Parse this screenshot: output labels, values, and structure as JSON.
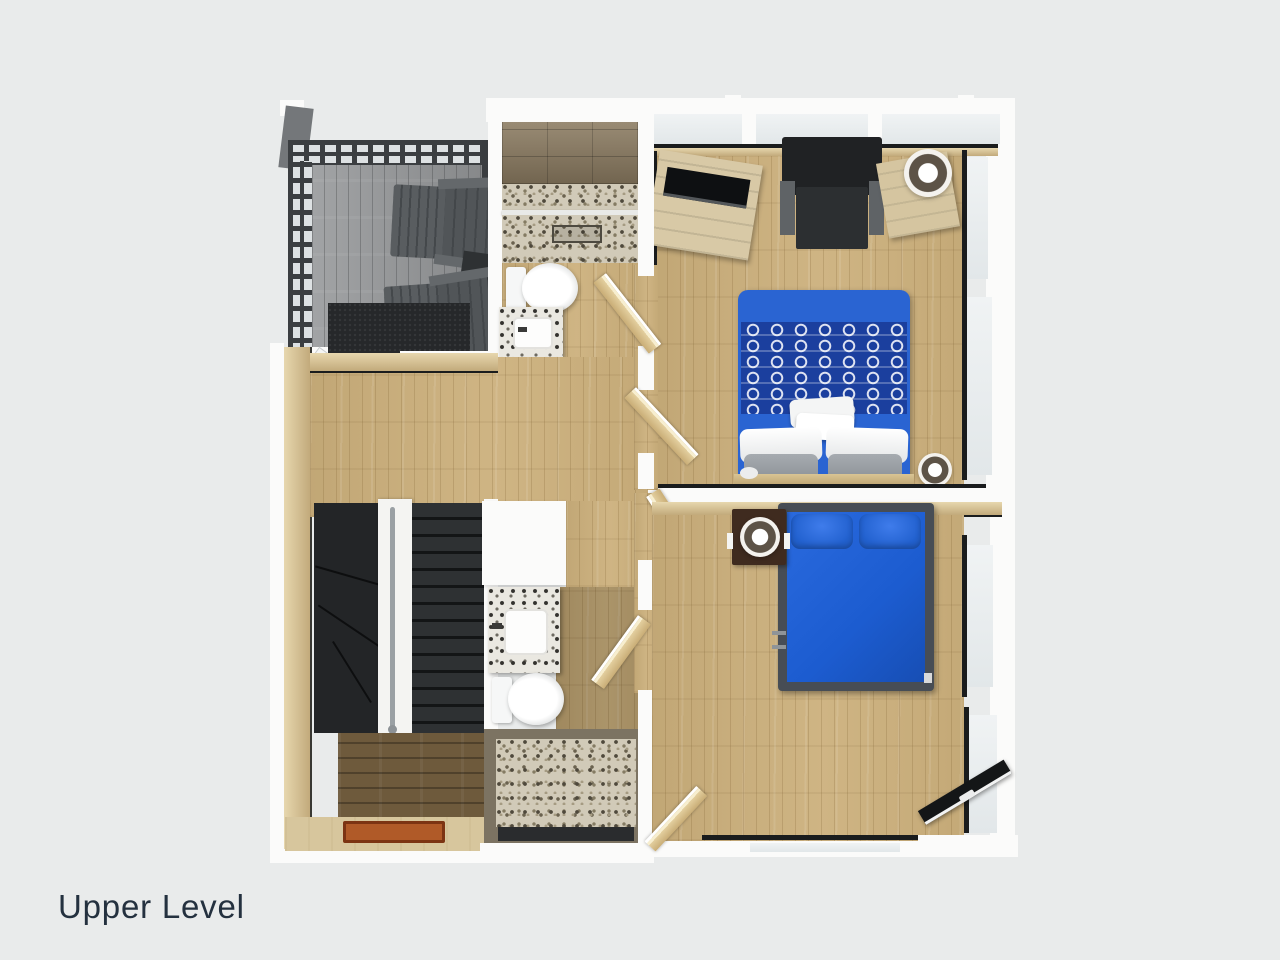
{
  "page": {
    "background_color": "#e9ebeb",
    "label": {
      "text": "Upper Level",
      "color": "#24313f"
    }
  },
  "palette": {
    "wall_white": "#fbfbfa",
    "trim_black": "#1a1c1d",
    "floor_oak": "#ccb07c",
    "floor_oak_dark": "#6e5a3c",
    "deck_gray": "#97999b",
    "accent_bed_blue": "#2261cf",
    "bed_runner_navy": "#1b3f9e",
    "stair_charcoal": "#2e3133",
    "pebble_tile": "#d1cab8",
    "shower_tile_brown": "#8b7b61"
  },
  "scene": {
    "type": "floor-plan-3d-render",
    "level": "Upper Level",
    "rooms": [
      {
        "id": "deck",
        "objects": [
          "pergola-lattice",
          "corner-post",
          "adirondack-chair",
          "adirondack-chair",
          "side-table",
          "doormat",
          "glass-door"
        ]
      },
      {
        "id": "bathroom-1",
        "objects": [
          "tiled-shower",
          "pebble-shower-floor",
          "shower-drain",
          "toilet",
          "vanity-sink",
          "door"
        ]
      },
      {
        "id": "bedroom-1",
        "objects": [
          "window-band",
          "dresser-with-tv",
          "armchair",
          "nightstand",
          "drum-lamp",
          "double-bed-blue",
          "patterned-runner",
          "pillows",
          "table-lamp",
          "door"
        ]
      },
      {
        "id": "hallway",
        "objects": [
          "staircase-down",
          "handrail",
          "stair-winders"
        ]
      },
      {
        "id": "bathroom-2",
        "objects": [
          "vanity-sink",
          "toilet",
          "pebble-shower",
          "door"
        ]
      },
      {
        "id": "bedroom-2",
        "objects": [
          "bed-blue-metal-frame",
          "pillows",
          "nightstand-dark",
          "drum-lamp",
          "window",
          "entry-door-black",
          "closet-door"
        ]
      }
    ]
  }
}
